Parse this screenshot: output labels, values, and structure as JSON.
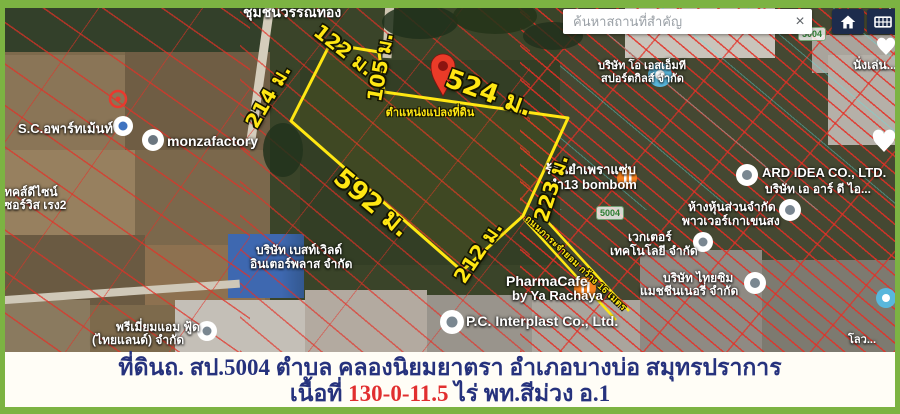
{
  "colors": {
    "frame_green": "#7cb342",
    "plot_yellow": "#ffe713",
    "cadastral_red": "#e23b32",
    "caption_blue": "#26327d",
    "caption_red": "#e12f2f",
    "pin_red": "#ea3b28"
  },
  "search": {
    "placeholder": "ค้นหาสถานที่สำคัญ",
    "clear": "×"
  },
  "map": {
    "measurements": [
      "214 ม.",
      "122 ม.",
      "105 ม.",
      "524 ม.",
      "223 ม.",
      "212 ม.",
      "592 ม."
    ],
    "pin_caption": "ตำแหน่งแปลงที่ดิน",
    "road_label": "ถนนภาระจำยอม กว้าง 16 เมตร",
    "route_badges": [
      "5004",
      "5004"
    ],
    "pois": {
      "community": "ชุมชนวรรณทอง",
      "apartment": "S.C.อพาร์ทเม้นท์",
      "monza": "monzafactory",
      "techdesign1": "เทคส์ดีไซน์",
      "techdesign2": "เซอร์วิส เรง2",
      "bestworld1": "บริษัท เบสท์เวิลด์",
      "bestworld2": "อินเตอร์พลาส จำกัด",
      "premium1": "พรีเมี่ยมแอม ฟู้ด",
      "premium2": "(ไทยแลนด์) จำกัด",
      "yum1": "ร้านยำเพราแซ่บ",
      "yum2": "ยำ13 bombom",
      "osm1": "บริษัท โอ เอสเอ็มที",
      "osm2": "สปอร์ตกิลส์ จำกัด",
      "ard1": "ARD IDEA CO., LTD.",
      "ard2": "บริษัท เอ อาร์ ดี ไอ...",
      "partnership1": "ห้างหุ้นส่วนจำกัด",
      "partnership2": "พาวเวอร์เกาเขนสง",
      "vector1": "เวกเตอร์",
      "vector2": "เทคโนโลยี จำกัด",
      "thaisim1": "บริษัท ไทยซิม",
      "thaisim2": "แมชชีนเนอรี่ จำกัด",
      "pharma1": "PharmaCafe",
      "pharma2": "by Ya Rachaya",
      "interplast": "P.C. Interplast Co., Ltd.",
      "nanglen": "นั่งเล่น...",
      "low": "โลว..."
    }
  },
  "caption": {
    "line1": "ที่ดินถ. สป.5004 ตำบล คลองนิยมยาตรา อำเภอบางบ่อ สมุทรปราการ",
    "line2_prefix": "เนื้อที่ ",
    "line2_area": "130-0-11.5",
    "line2_suffix": " ไร่  พท.สีม่วง อ.1"
  }
}
